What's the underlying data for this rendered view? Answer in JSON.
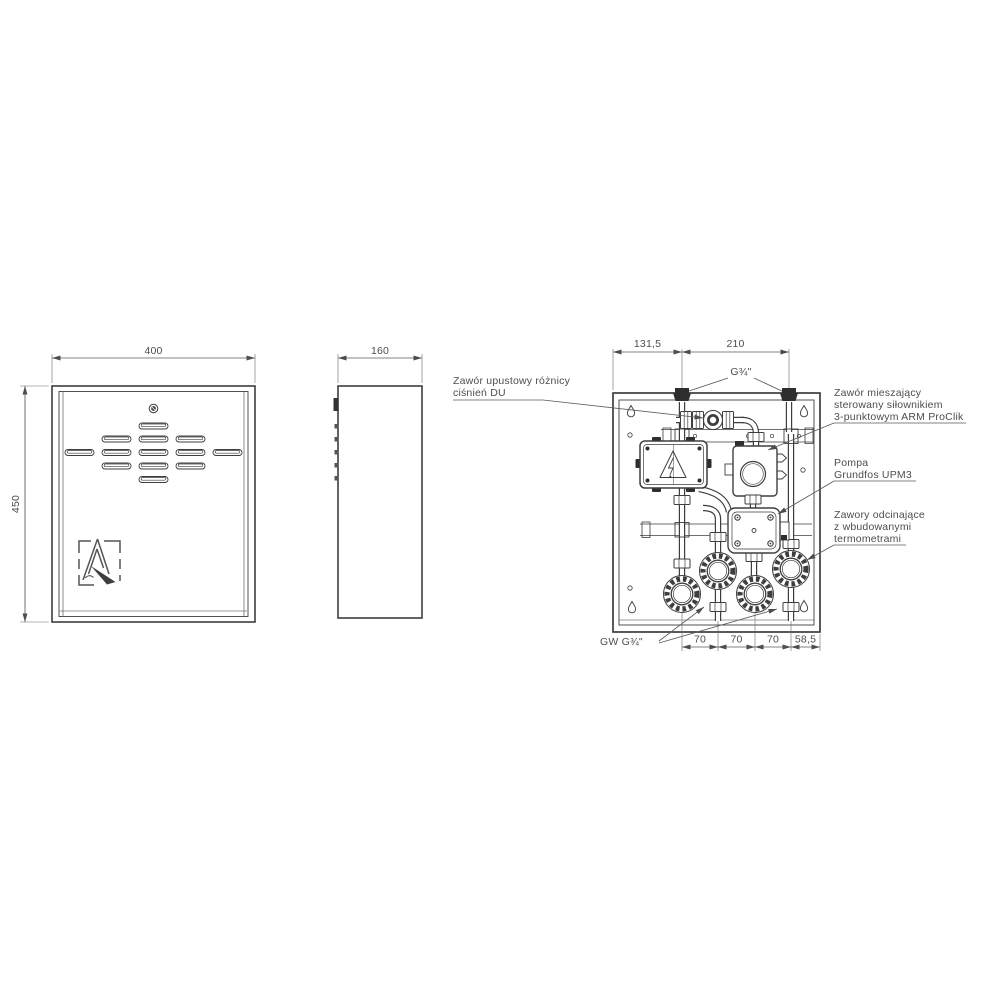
{
  "views": {
    "front": {
      "width_dim": "400",
      "height_dim": "450"
    },
    "side": {
      "width_dim": "160"
    },
    "internal": {
      "dims": {
        "left": "131,5",
        "center": "210",
        "sp1": "70",
        "sp2": "70",
        "sp3": "70",
        "right": "58,5"
      },
      "ports": {
        "top": "G¾\"",
        "bottom": "GW G¾\""
      },
      "labels": {
        "du_valve": {
          "l1": "Zawór upustowy różnicy",
          "l2": "ciśnień DU"
        },
        "mixing_valve": {
          "l1": "Zawór mieszający",
          "l2": "sterowany siłownikiem",
          "l3": "3-punktowym ARM ProClik"
        },
        "pump": {
          "l1": "Pompa",
          "l2": "Grundfos UPM3"
        },
        "shutoff": {
          "l1": "Zawory odcinające",
          "l2": "z wbudowanymi",
          "l3": "termometrami"
        }
      }
    }
  }
}
